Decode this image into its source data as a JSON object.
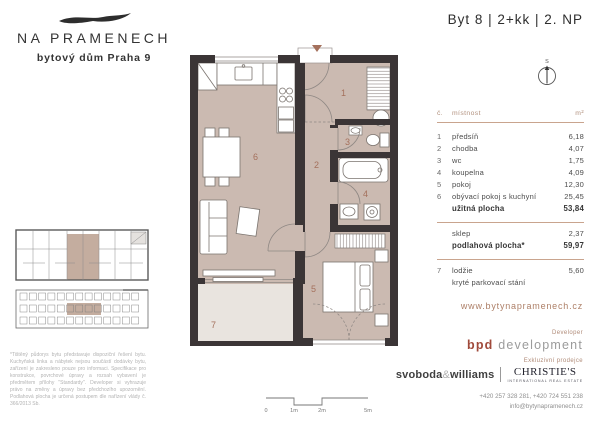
{
  "brand": {
    "name": "NA PRAMENECH",
    "subtitle": "bytový dům Praha 9"
  },
  "header": {
    "title": "Byt 8  |  2+kk  |  2. NP",
    "compass": "S"
  },
  "accent_colors": {
    "table_line": "#c9a48e",
    "room_fill": "#cbbab1",
    "loggia_fill": "#e9e4df",
    "wall": "#3b3536",
    "room_number": "#a4705c",
    "bpd_red": "#a04a3b",
    "link_brown": "#ad7f67"
  },
  "table": {
    "col_no": "č.",
    "col_room": "místnost",
    "col_area": "m²",
    "rows": [
      {
        "no": "1",
        "name": "předsíň",
        "area": "6,18"
      },
      {
        "no": "2",
        "name": "chodba",
        "area": "4,07"
      },
      {
        "no": "3",
        "name": "wc",
        "area": "1,75"
      },
      {
        "no": "4",
        "name": "koupelna",
        "area": "4,09"
      },
      {
        "no": "5",
        "name": "pokoj",
        "area": "12,30"
      },
      {
        "no": "6",
        "name": "obývací pokoj s kuchyní",
        "area": "25,45"
      },
      {
        "no": "",
        "name": "užitná plocha",
        "area": "53,84"
      },
      {
        "no": "",
        "name": "sklep",
        "area": "2,37"
      },
      {
        "no": "",
        "name": "podlahová plocha*",
        "area": "59,97"
      },
      {
        "no": "7",
        "name": "lodžie",
        "area": "5,60"
      },
      {
        "no": "",
        "name": "kryté parkovací stání",
        "area": ""
      }
    ]
  },
  "website": "www.bytynapramenech.cz",
  "developer": {
    "label": "Developer",
    "bpd": "bpd",
    "dev": "development"
  },
  "sales": {
    "label": "Exkluzivní prodejce",
    "sw1": "svoboda",
    "amp": "&",
    "sw2": "williams",
    "christies": "CHRISTIE'S",
    "christies_sub": "INTERNATIONAL REAL ESTATE"
  },
  "contact": {
    "phones": "+420 257 328 281, +420 724 551 238",
    "email": "info@bytynapramenech.cz"
  },
  "footnote": "*Tištěný půdorys bytu představuje dispoziční řešení bytu. Kuchyňská linka a nábytek nejsou součástí dodávky bytu, zařízení je zakresleno pouze pro informaci. Specifikace pro konstrukce, povrchové úpravy a rozsah vybavení je předmětem přílohy \"Standardy\". Developer si vyhrazuje právo na změny a úpravy bez předchozího upozornění. Podlahová plocha je určená postupem dle nařízení vlády č. 366/2013 Sb.",
  "scalebar": {
    "labels": [
      "0",
      "1m",
      "2m",
      "5m"
    ]
  },
  "plan": {
    "rooms": [
      "1",
      "2",
      "3",
      "4",
      "5",
      "6",
      "7"
    ]
  }
}
